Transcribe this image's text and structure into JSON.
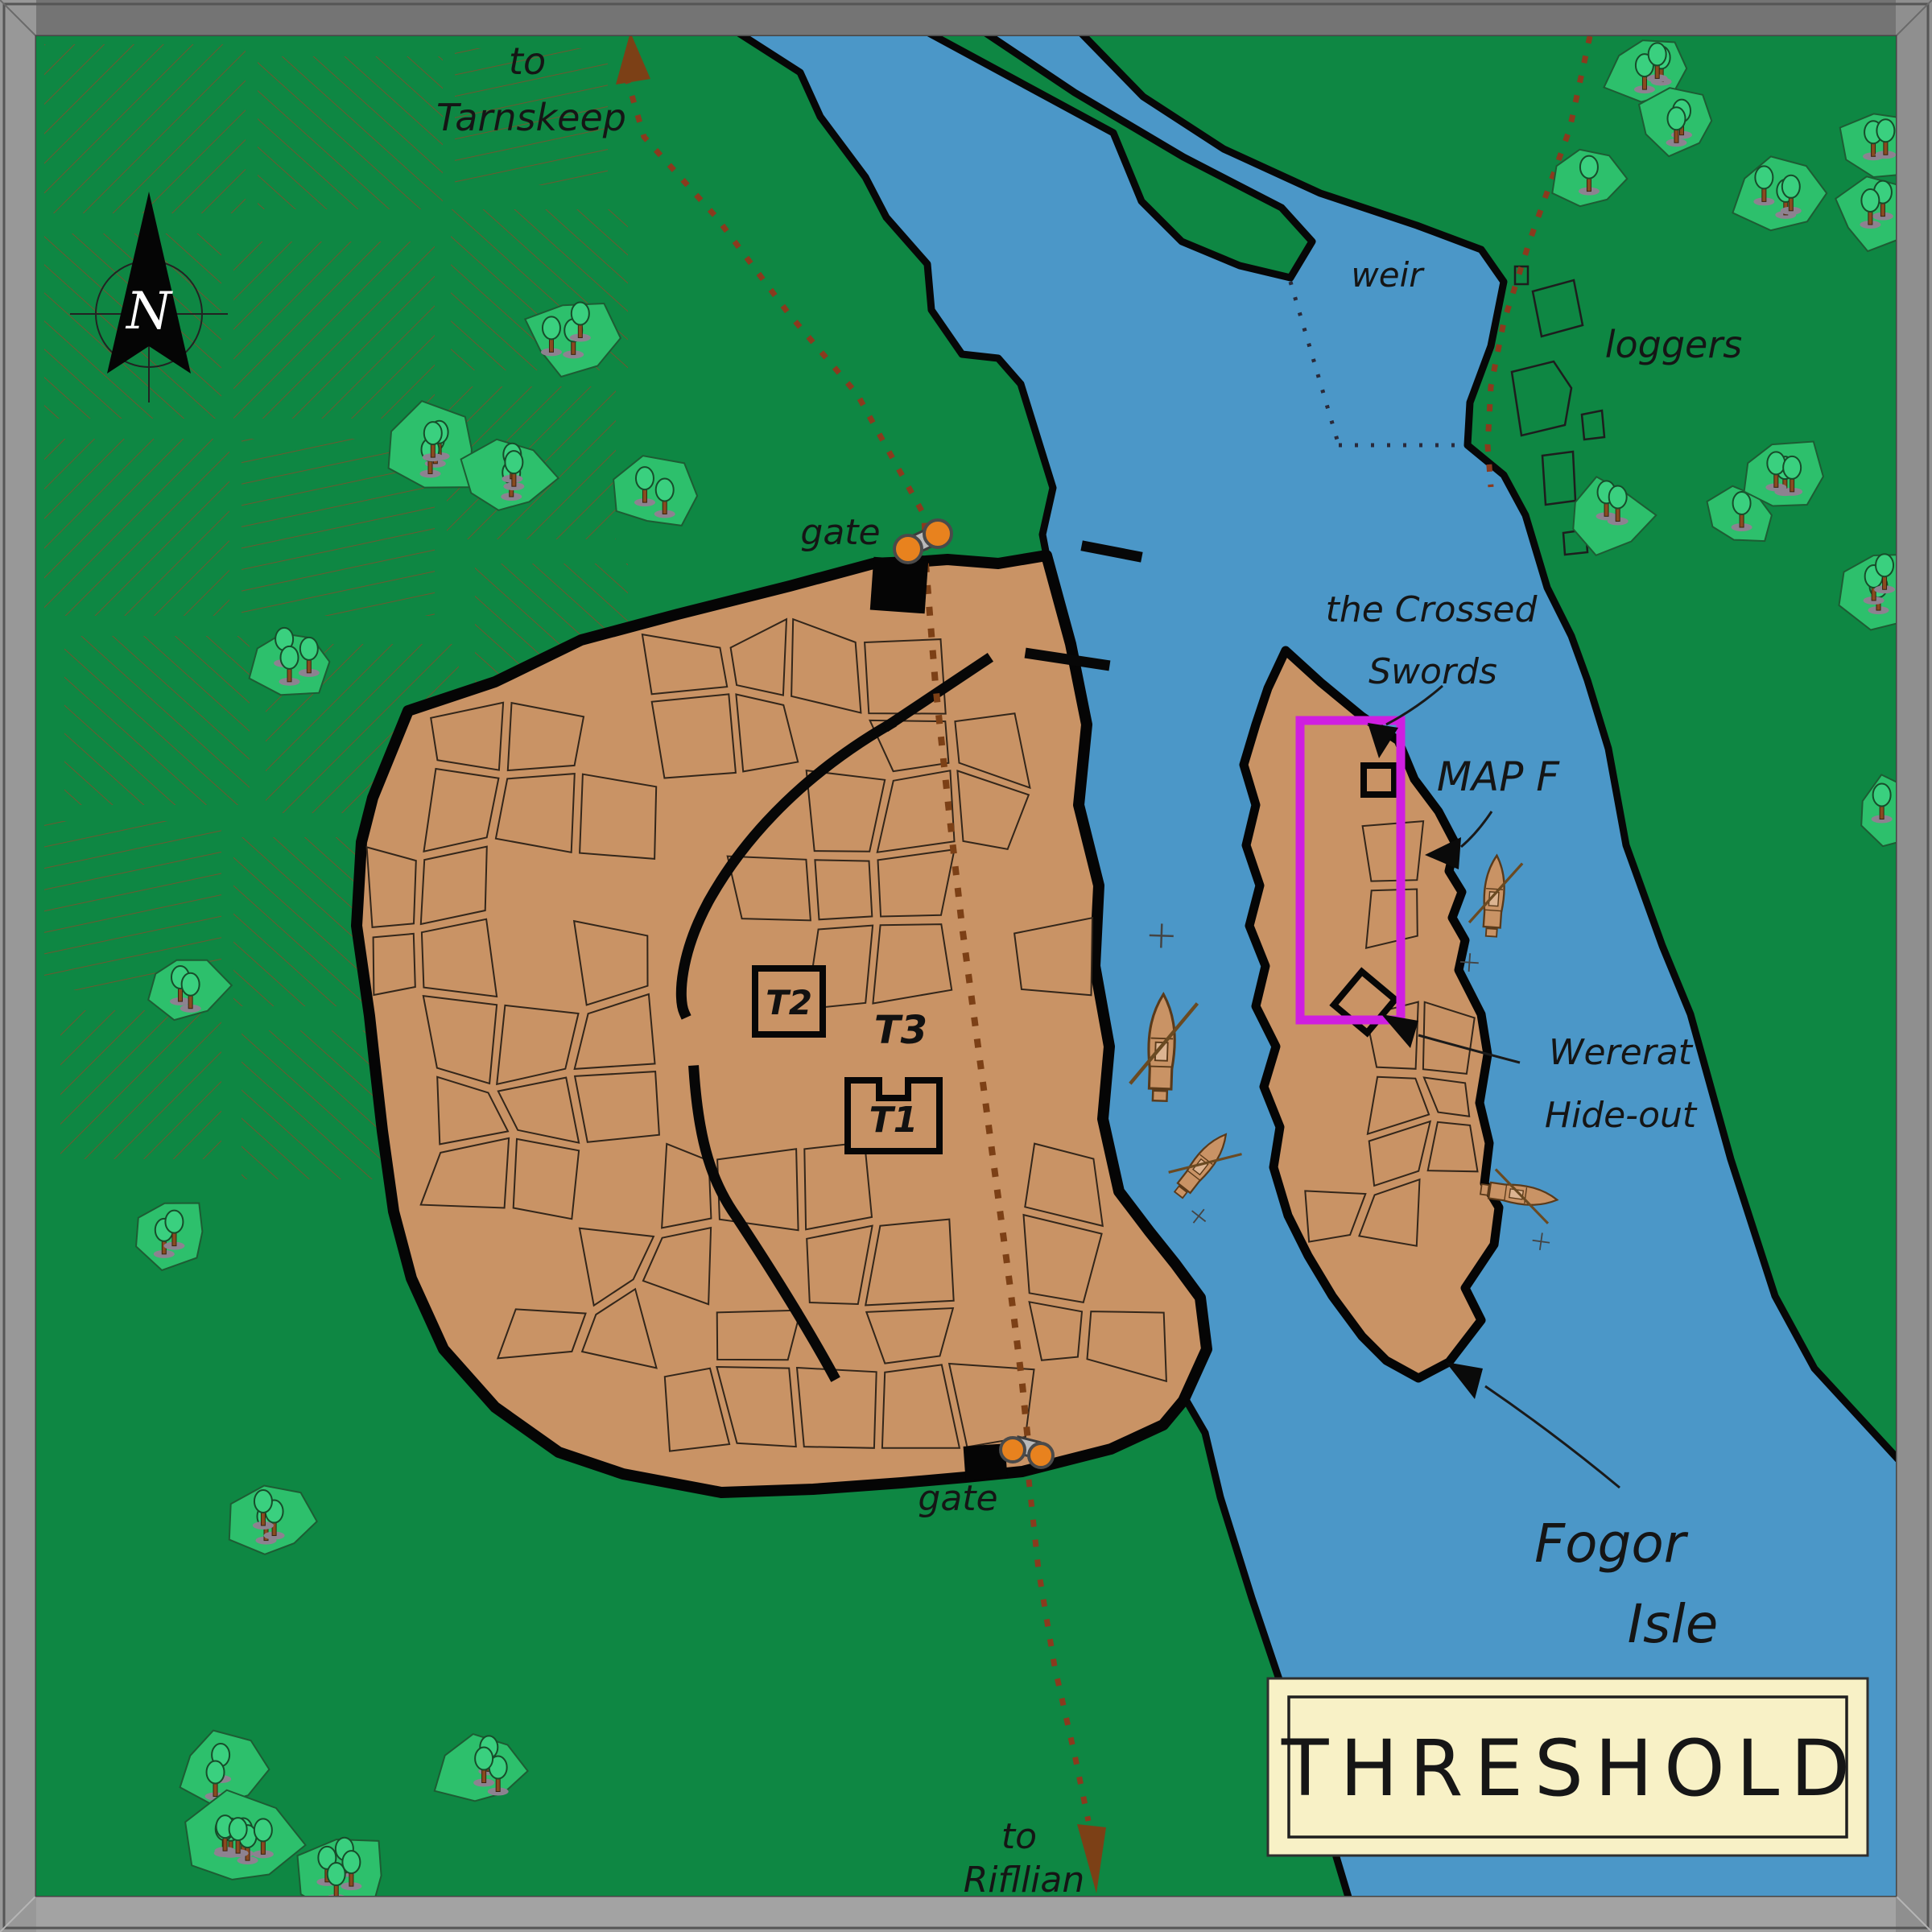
{
  "map_title": "THRESHOLD",
  "compass": {
    "north_letter": "N"
  },
  "labels": {
    "tarnskeep_line1": "to",
    "tarnskeep_line2": "Tarnskeep",
    "weir": "weir",
    "loggers": "loggers",
    "gate_north": "gate",
    "gate_south": "gate",
    "crossed_line1": "the Crossed",
    "crossed_line2": "Swords",
    "map_f": "MAP F",
    "wererat_line1": "Wererat",
    "wererat_line2": "Hide-out",
    "t1": "T1",
    "t2": "T2",
    "t3": "T3",
    "rifllian_line1": "to",
    "rifllian_line2": "Rifllian",
    "fogor_line1": "Fogor",
    "fogor_line2": "Isle"
  },
  "colors": {
    "land_green": "#0e8743",
    "water_blue": "#4b97c8",
    "city_tan": "#c99365",
    "highlight_magenta": "#cf1fe0",
    "road_brown": "#8a3a1e",
    "tower_orange": "#e8821e",
    "title_cream": "#f8f1c6",
    "frame_gray": "#9c9c9c"
  }
}
